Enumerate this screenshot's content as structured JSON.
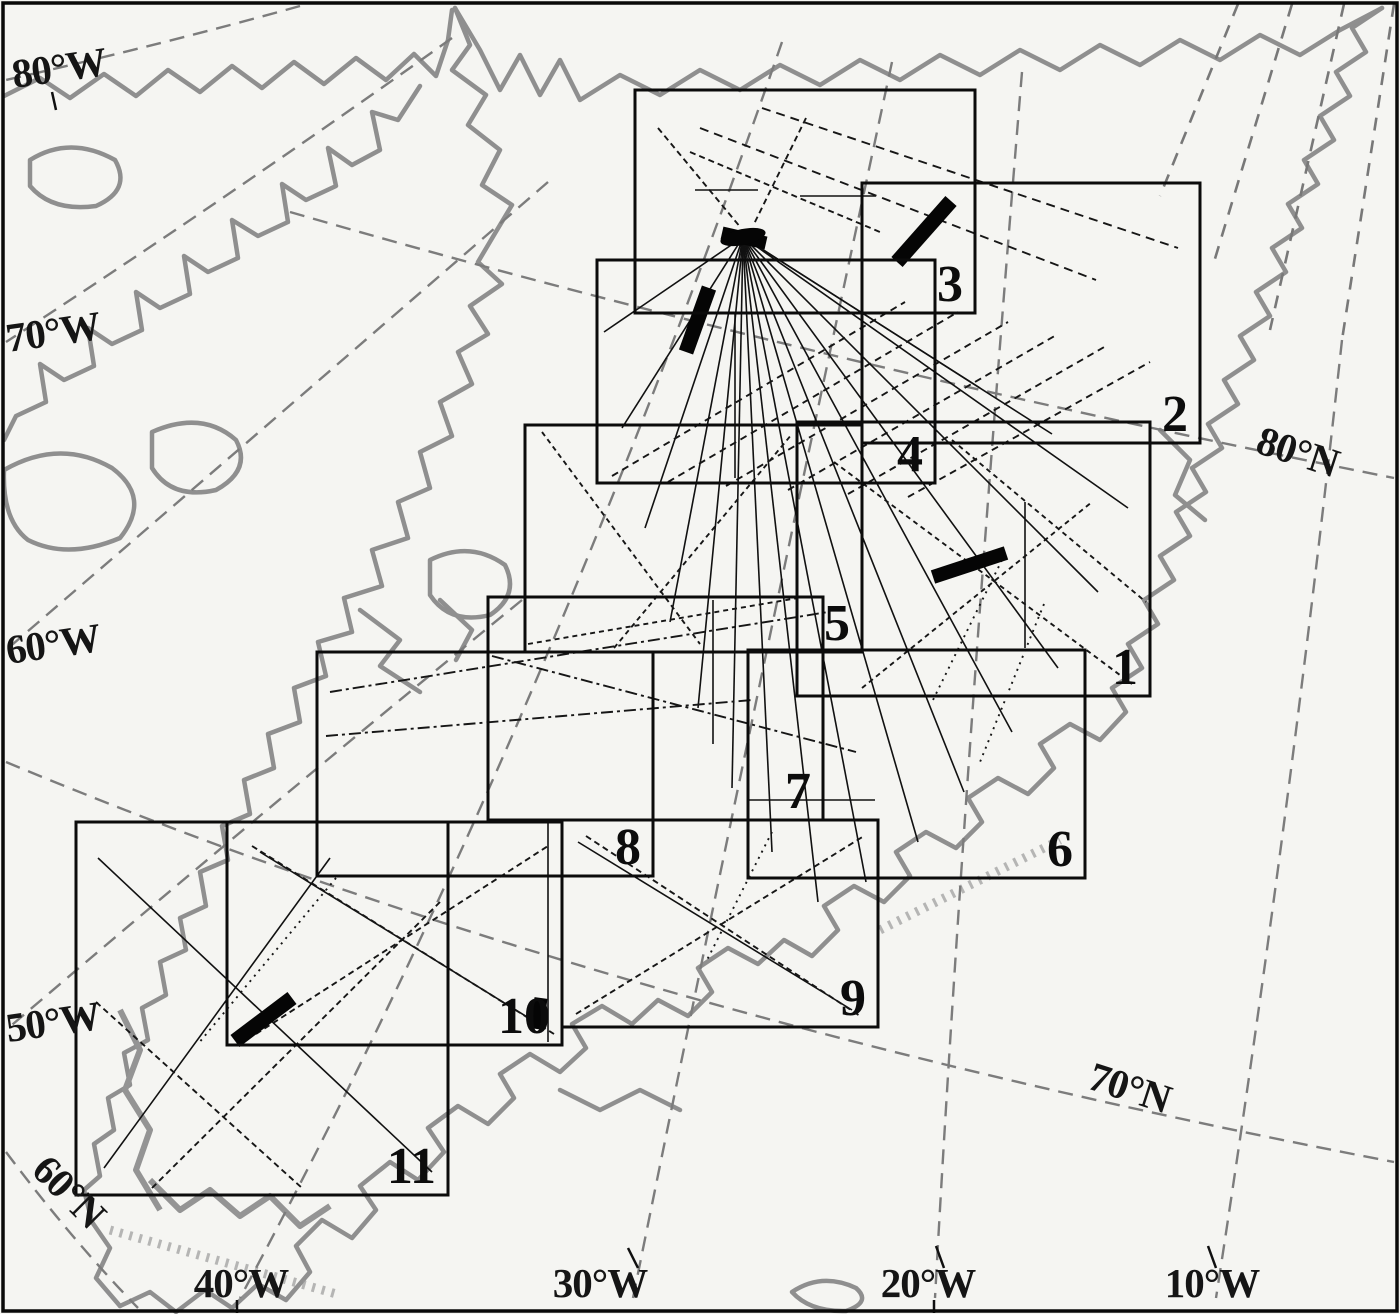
{
  "map": {
    "background_color": "#f5f5f2",
    "coast_color": "#8f8f8f",
    "line_color": "#0b0b0b",
    "regions": [
      {
        "label": "1",
        "x": 797,
        "y": 422,
        "w": 353,
        "h": 274
      },
      {
        "label": "2",
        "x": 862,
        "y": 183,
        "w": 338,
        "h": 260
      },
      {
        "label": "3",
        "x": 635,
        "y": 90,
        "w": 340,
        "h": 223
      },
      {
        "label": "4",
        "x": 597,
        "y": 260,
        "w": 338,
        "h": 223
      },
      {
        "label": "5",
        "x": 525,
        "y": 425,
        "w": 337,
        "h": 227
      },
      {
        "label": "6",
        "x": 748,
        "y": 650,
        "w": 337,
        "h": 228
      },
      {
        "label": "7",
        "x": 488,
        "y": 597,
        "w": 335,
        "h": 223
      },
      {
        "label": "8",
        "x": 317,
        "y": 652,
        "w": 336,
        "h": 224
      },
      {
        "label": "9",
        "x": 562,
        "y": 820,
        "w": 316,
        "h": 207
      },
      {
        "label": "10",
        "x": 227,
        "y": 822,
        "w": 335,
        "h": 223
      },
      {
        "label": "11",
        "x": 76,
        "y": 822,
        "w": 372,
        "h": 373
      }
    ],
    "coordinate_labels": [
      {
        "text": "80°W",
        "x": 14,
        "y": 88,
        "rotate": -8,
        "anchor": "start"
      },
      {
        "text": "70°W",
        "x": 8,
        "y": 352,
        "rotate": -8,
        "anchor": "start"
      },
      {
        "text": "60°W",
        "x": 8,
        "y": 664,
        "rotate": -8,
        "anchor": "start"
      },
      {
        "text": "50°W",
        "x": 8,
        "y": 1042,
        "rotate": -8,
        "anchor": "start"
      },
      {
        "text": "60°N",
        "x": 30,
        "y": 1172,
        "rotate": 45,
        "anchor": "start"
      },
      {
        "text": "80°N",
        "x": 1254,
        "y": 452,
        "rotate": 18,
        "anchor": "start"
      },
      {
        "text": "70°N",
        "x": 1086,
        "y": 1088,
        "rotate": 18,
        "anchor": "start"
      },
      {
        "text": "40°W",
        "x": 241,
        "y": 1297,
        "rotate": 0,
        "anchor": "middle"
      },
      {
        "text": "30°W",
        "x": 600,
        "y": 1297,
        "rotate": 0,
        "anchor": "middle"
      },
      {
        "text": "20°W",
        "x": 928,
        "y": 1297,
        "rotate": 0,
        "anchor": "middle"
      },
      {
        "text": "10°W",
        "x": 1212,
        "y": 1297,
        "rotate": 0,
        "anchor": "middle"
      }
    ],
    "flight_hub": {
      "x": 743,
      "y": 237
    },
    "fan_endpoints": [
      [
        604,
        332
      ],
      [
        622,
        428
      ],
      [
        645,
        528
      ],
      [
        670,
        622
      ],
      [
        698,
        708
      ],
      [
        732,
        788
      ],
      [
        772,
        852
      ],
      [
        818,
        902
      ],
      [
        866,
        882
      ],
      [
        918,
        842
      ],
      [
        964,
        792
      ],
      [
        1012,
        732
      ],
      [
        1058,
        668
      ],
      [
        1098,
        592
      ],
      [
        1128,
        508
      ],
      [
        980,
        388
      ],
      [
        1052,
        434
      ]
    ],
    "thick_bars": [
      {
        "x1": 897,
        "y1": 262,
        "x2": 951,
        "y2": 201,
        "w": 15
      },
      {
        "x1": 686,
        "y1": 352,
        "x2": 709,
        "y2": 288,
        "w": 15
      },
      {
        "x1": 933,
        "y1": 577,
        "x2": 1006,
        "y2": 553,
        "w": 14
      },
      {
        "x1": 235,
        "y1": 1041,
        "x2": 292,
        "y2": 998,
        "w": 15
      },
      {
        "x1": 537,
        "y1": 1029,
        "x2": 541,
        "y2": 998,
        "w": 13
      },
      {
        "x1": 722,
        "y1": 233,
        "x2": 766,
        "y2": 243,
        "w": 13
      }
    ],
    "dashed_lines": [
      {
        "x1": 612,
        "y1": 476,
        "x2": 905,
        "y2": 302,
        "dash": "7 5"
      },
      {
        "x1": 668,
        "y1": 482,
        "x2": 958,
        "y2": 312,
        "dash": "7 5"
      },
      {
        "x1": 726,
        "y1": 486,
        "x2": 1008,
        "y2": 322,
        "dash": "7 5"
      },
      {
        "x1": 788,
        "y1": 490,
        "x2": 1058,
        "y2": 334,
        "dash": "7 5"
      },
      {
        "x1": 848,
        "y1": 494,
        "x2": 1106,
        "y2": 346,
        "dash": "7 5"
      },
      {
        "x1": 908,
        "y1": 497,
        "x2": 1150,
        "y2": 362,
        "dash": "7 5"
      },
      {
        "x1": 700,
        "y1": 128,
        "x2": 1096,
        "y2": 280,
        "dash": "9 6"
      },
      {
        "x1": 762,
        "y1": 108,
        "x2": 1178,
        "y2": 248,
        "dash": "9 6"
      },
      {
        "x1": 658,
        "y1": 128,
        "x2": 741,
        "y2": 228,
        "dash": "6 4"
      },
      {
        "x1": 806,
        "y1": 118,
        "x2": 754,
        "y2": 224,
        "dash": "6 4"
      },
      {
        "x1": 690,
        "y1": 152,
        "x2": 880,
        "y2": 232,
        "dash": "6 4"
      },
      {
        "x1": 330,
        "y1": 692,
        "x2": 828,
        "y2": 612,
        "dash": "12 4 3 4"
      },
      {
        "x1": 326,
        "y1": 736,
        "x2": 752,
        "y2": 700,
        "dash": "12 4 3 4"
      },
      {
        "x1": 492,
        "y1": 656,
        "x2": 856,
        "y2": 752,
        "dash": "12 4 3 4"
      },
      {
        "x1": 528,
        "y1": 644,
        "x2": 798,
        "y2": 598,
        "dash": "5 4"
      },
      {
        "x1": 542,
        "y1": 432,
        "x2": 700,
        "y2": 644,
        "dash": "5 4"
      },
      {
        "x1": 614,
        "y1": 648,
        "x2": 792,
        "y2": 434,
        "dash": "5 4"
      },
      {
        "x1": 834,
        "y1": 462,
        "x2": 1132,
        "y2": 684,
        "dash": "5 4"
      },
      {
        "x1": 862,
        "y1": 688,
        "x2": 1092,
        "y2": 502,
        "dash": "5 4"
      },
      {
        "x1": 952,
        "y1": 440,
        "x2": 1146,
        "y2": 602,
        "dash": "5 4"
      },
      {
        "x1": 1002,
        "y1": 560,
        "x2": 932,
        "y2": 702,
        "dash": "2 5"
      },
      {
        "x1": 1044,
        "y1": 604,
        "x2": 980,
        "y2": 762,
        "dash": "2 5"
      },
      {
        "x1": 772,
        "y1": 832,
        "x2": 706,
        "y2": 962,
        "dash": "2 5"
      },
      {
        "x1": 576,
        "y1": 1014,
        "x2": 864,
        "y2": 836,
        "dash": "6 4"
      },
      {
        "x1": 586,
        "y1": 836,
        "x2": 860,
        "y2": 1016,
        "dash": "6 4"
      },
      {
        "x1": 252,
        "y1": 846,
        "x2": 554,
        "y2": 1034,
        "dash": "6 4"
      },
      {
        "x1": 256,
        "y1": 1034,
        "x2": 548,
        "y2": 846,
        "dash": "6 4"
      },
      {
        "x1": 96,
        "y1": 1002,
        "x2": 302,
        "y2": 1188,
        "dash": "6 4"
      },
      {
        "x1": 152,
        "y1": 1188,
        "x2": 440,
        "y2": 902,
        "dash": "6 4"
      },
      {
        "x1": 336,
        "y1": 878,
        "x2": 198,
        "y2": 1044,
        "dash": "2 5"
      }
    ],
    "solid_lines": [
      {
        "x1": 98,
        "y1": 858,
        "x2": 432,
        "y2": 1172
      },
      {
        "x1": 104,
        "y1": 1168,
        "x2": 330,
        "y2": 858
      },
      {
        "x1": 548,
        "y1": 822,
        "x2": 548,
        "y2": 1042
      },
      {
        "x1": 578,
        "y1": 842,
        "x2": 852,
        "y2": 1010
      },
      {
        "x1": 260,
        "y1": 852,
        "x2": 545,
        "y2": 1028
      },
      {
        "x1": 695,
        "y1": 190,
        "x2": 758,
        "y2": 190
      },
      {
        "x1": 800,
        "y1": 196,
        "x2": 876,
        "y2": 196
      },
      {
        "x1": 713,
        "y1": 600,
        "x2": 713,
        "y2": 744
      },
      {
        "x1": 735,
        "y1": 312,
        "x2": 735,
        "y2": 478
      },
      {
        "x1": 1025,
        "y1": 502,
        "x2": 1025,
        "y2": 648
      },
      {
        "x1": 748,
        "y1": 800,
        "x2": 875,
        "y2": 800
      }
    ],
    "ticks": [
      {
        "x1": 628,
        "y1": 1248,
        "x2": 638,
        "y2": 1268
      },
      {
        "x1": 936,
        "y1": 1246,
        "x2": 944,
        "y2": 1268
      },
      {
        "x1": 1208,
        "y1": 1246,
        "x2": 1216,
        "y2": 1268
      },
      {
        "x1": 237,
        "y1": 1300,
        "x2": 237,
        "y2": 1313
      },
      {
        "x1": 934,
        "y1": 1300,
        "x2": 934,
        "y2": 1313
      },
      {
        "x1": 52,
        "y1": 92,
        "x2": 56,
        "y2": 110
      }
    ]
  }
}
